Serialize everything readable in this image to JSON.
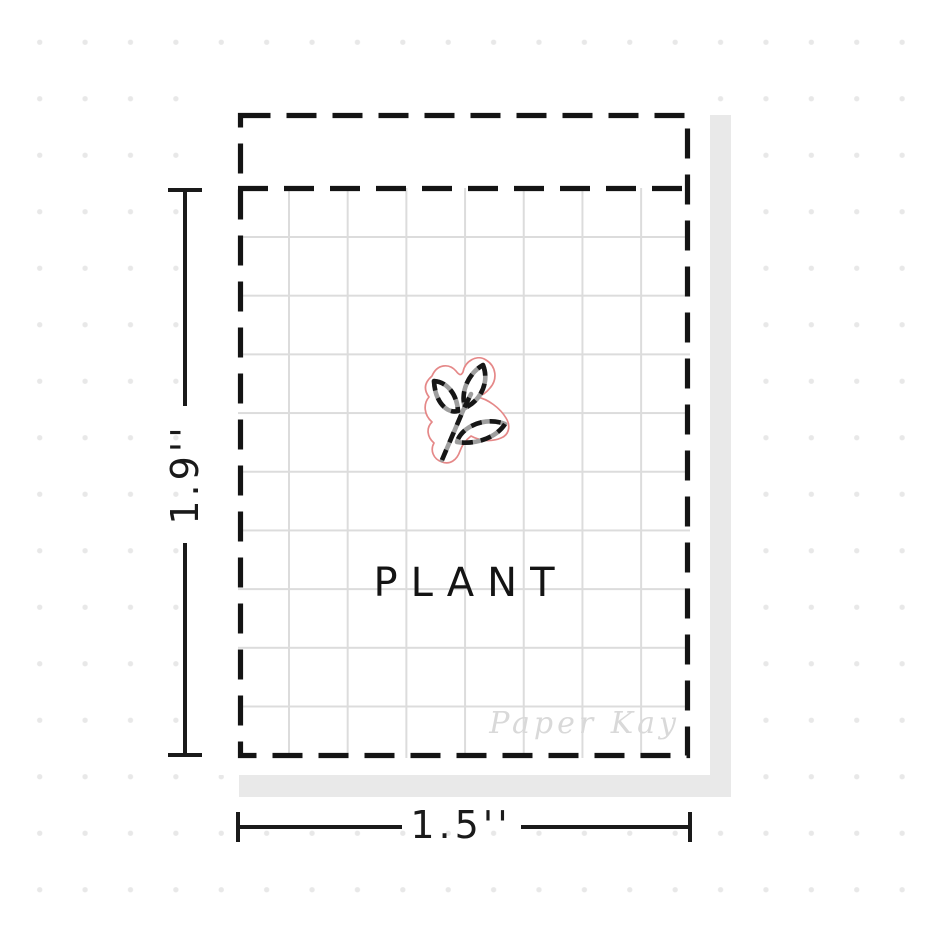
{
  "sticker_sheet": {
    "sticker_label": "PLANT",
    "watermark": "Paper Kay",
    "icon": "plant-sprig-icon"
  },
  "dimensions": {
    "height_label": "1.9''",
    "width_label": "1.5''"
  },
  "colors": {
    "background_dot": "#e8e8e8",
    "sheet_shadow": "#e9e9e9",
    "grid_line": "#dcdcdc",
    "outline_black": "#141414",
    "watermark_gray": "#d9d9d9",
    "die_cut_red": "#e58888"
  }
}
